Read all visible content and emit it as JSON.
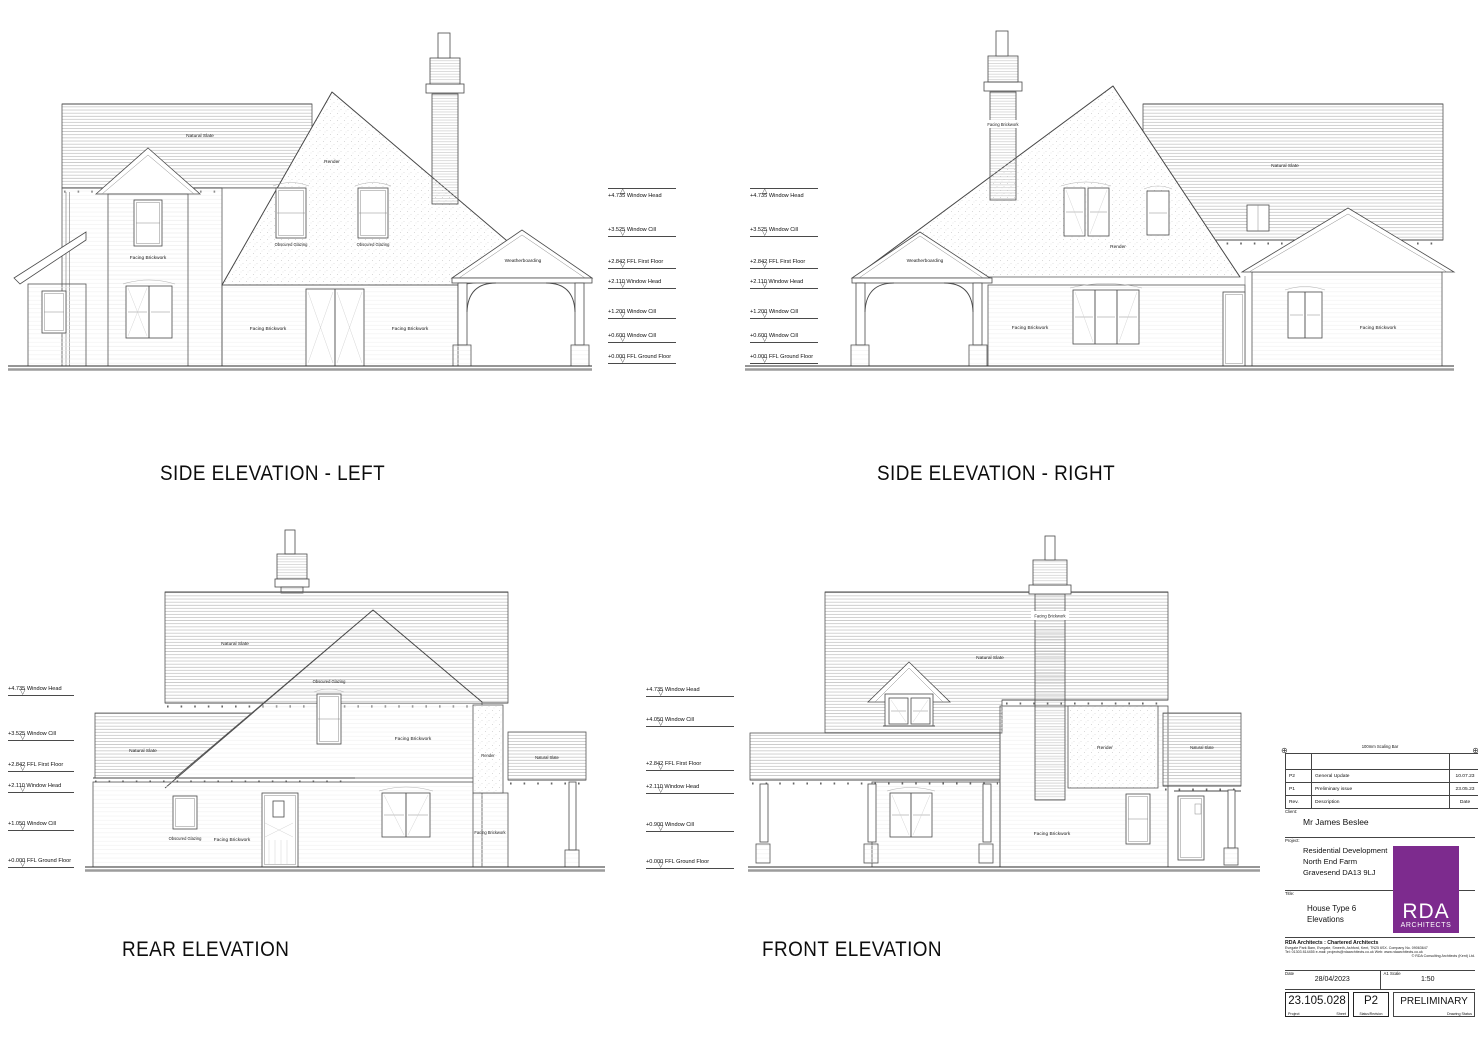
{
  "page": {
    "background": "#ffffff",
    "line": "#3f3f3f",
    "accent_purple": "#7d2b8e"
  },
  "materials": {
    "natural_slate": "Natural Slate",
    "render": "Render",
    "facing_brickwork": "Facing Brickwork",
    "obscured_glazing": "Obscured Glazing",
    "weatherboarding": "Weatherboarding"
  },
  "elevation_titles": {
    "side_left": "SIDE ELEVATION - LEFT",
    "side_right": "SIDE ELEVATION - RIGHT",
    "rear": "REAR ELEVATION",
    "front": "FRONT ELEVATION"
  },
  "levels": {
    "side_left": [
      {
        "label": "+4.735 Window Head"
      },
      {
        "label": "+3.525 Window Cill"
      },
      {
        "label": "+2.842 FFL First Floor"
      },
      {
        "label": "+2.110 Window Head"
      },
      {
        "label": "+1.200 Window Cill"
      },
      {
        "label": "+0.600 Window Cill"
      },
      {
        "label": "+0.000 FFL Ground Floor"
      }
    ],
    "side_right": [
      {
        "label": "+4.735 Window Head"
      },
      {
        "label": "+3.525 Window Cill"
      },
      {
        "label": "+2.842 FFL First Floor"
      },
      {
        "label": "+2.110 Window Head"
      },
      {
        "label": "+1.200 Window Cill"
      },
      {
        "label": "+0.600 Window Cill"
      },
      {
        "label": "+0.000 FFL Ground Floor"
      }
    ],
    "rear": [
      {
        "label": "+4.735 Window Head"
      },
      {
        "label": "+3.525 Window Cill"
      },
      {
        "label": "+2.842 FFL First Floor"
      },
      {
        "label": "+2.110 Window Head"
      },
      {
        "label": "+1.050 Window Cill"
      },
      {
        "label": "+0.000 FFL Ground Floor"
      }
    ],
    "front": [
      {
        "label": "+4.735 Window Head"
      },
      {
        "label": "+4.050 Window Cill"
      },
      {
        "label": "+2.842 FFL First Floor"
      },
      {
        "label": "+2.110 Window Head"
      },
      {
        "label": "+0.900 Window Cill"
      },
      {
        "label": "+0.000 FFL Ground Floor"
      }
    ]
  },
  "title_block": {
    "scaling_bar": "100mm Scaling Bar",
    "revisions": [
      {
        "rev": "P2",
        "description": "General Update",
        "date": "10.07.23"
      },
      {
        "rev": "P1",
        "description": "Preliminary issue",
        "date": "23.05.23"
      }
    ],
    "revision_header": {
      "rev": "Rev.",
      "description": "Description",
      "date": "Date"
    },
    "client_label": "Client:",
    "client": "Mr James Beslee",
    "project_label": "Project:",
    "project_lines": [
      "Residential Development",
      "North End Farm",
      "Gravesend DA13 9LJ"
    ],
    "title_label": "Title:",
    "title_lines": [
      "House Type 6",
      "Elevations"
    ],
    "logo": {
      "line1": "RDA",
      "line2": "ARCHITECTS"
    },
    "firm": "RDA Architects : Chartered Architects",
    "address_line1": "Evegate Park Barn, Evegate, Smeeth, Ashford, Kent, TN25 6SX.  Company No. 09063647",
    "address_line2": "Tel: 01303 814455   e-mail: projects@rdaarchitects.co.uk   Web: www.rdaarchitects.co.uk",
    "copyright": "© RDA Consulting Architects (Kent) Ltd.",
    "date_label": "Date",
    "date": "28/04/2023",
    "scale_label": "A1 Scale",
    "scale": "1:50",
    "drawing_number": "23.105.028",
    "project_caption": "Project",
    "sheet_caption": "Sheet",
    "revision_box": "P2",
    "revision_caption": "Status/Revision",
    "status": "PRELIMINARY",
    "status_caption": "Drawing Status"
  }
}
